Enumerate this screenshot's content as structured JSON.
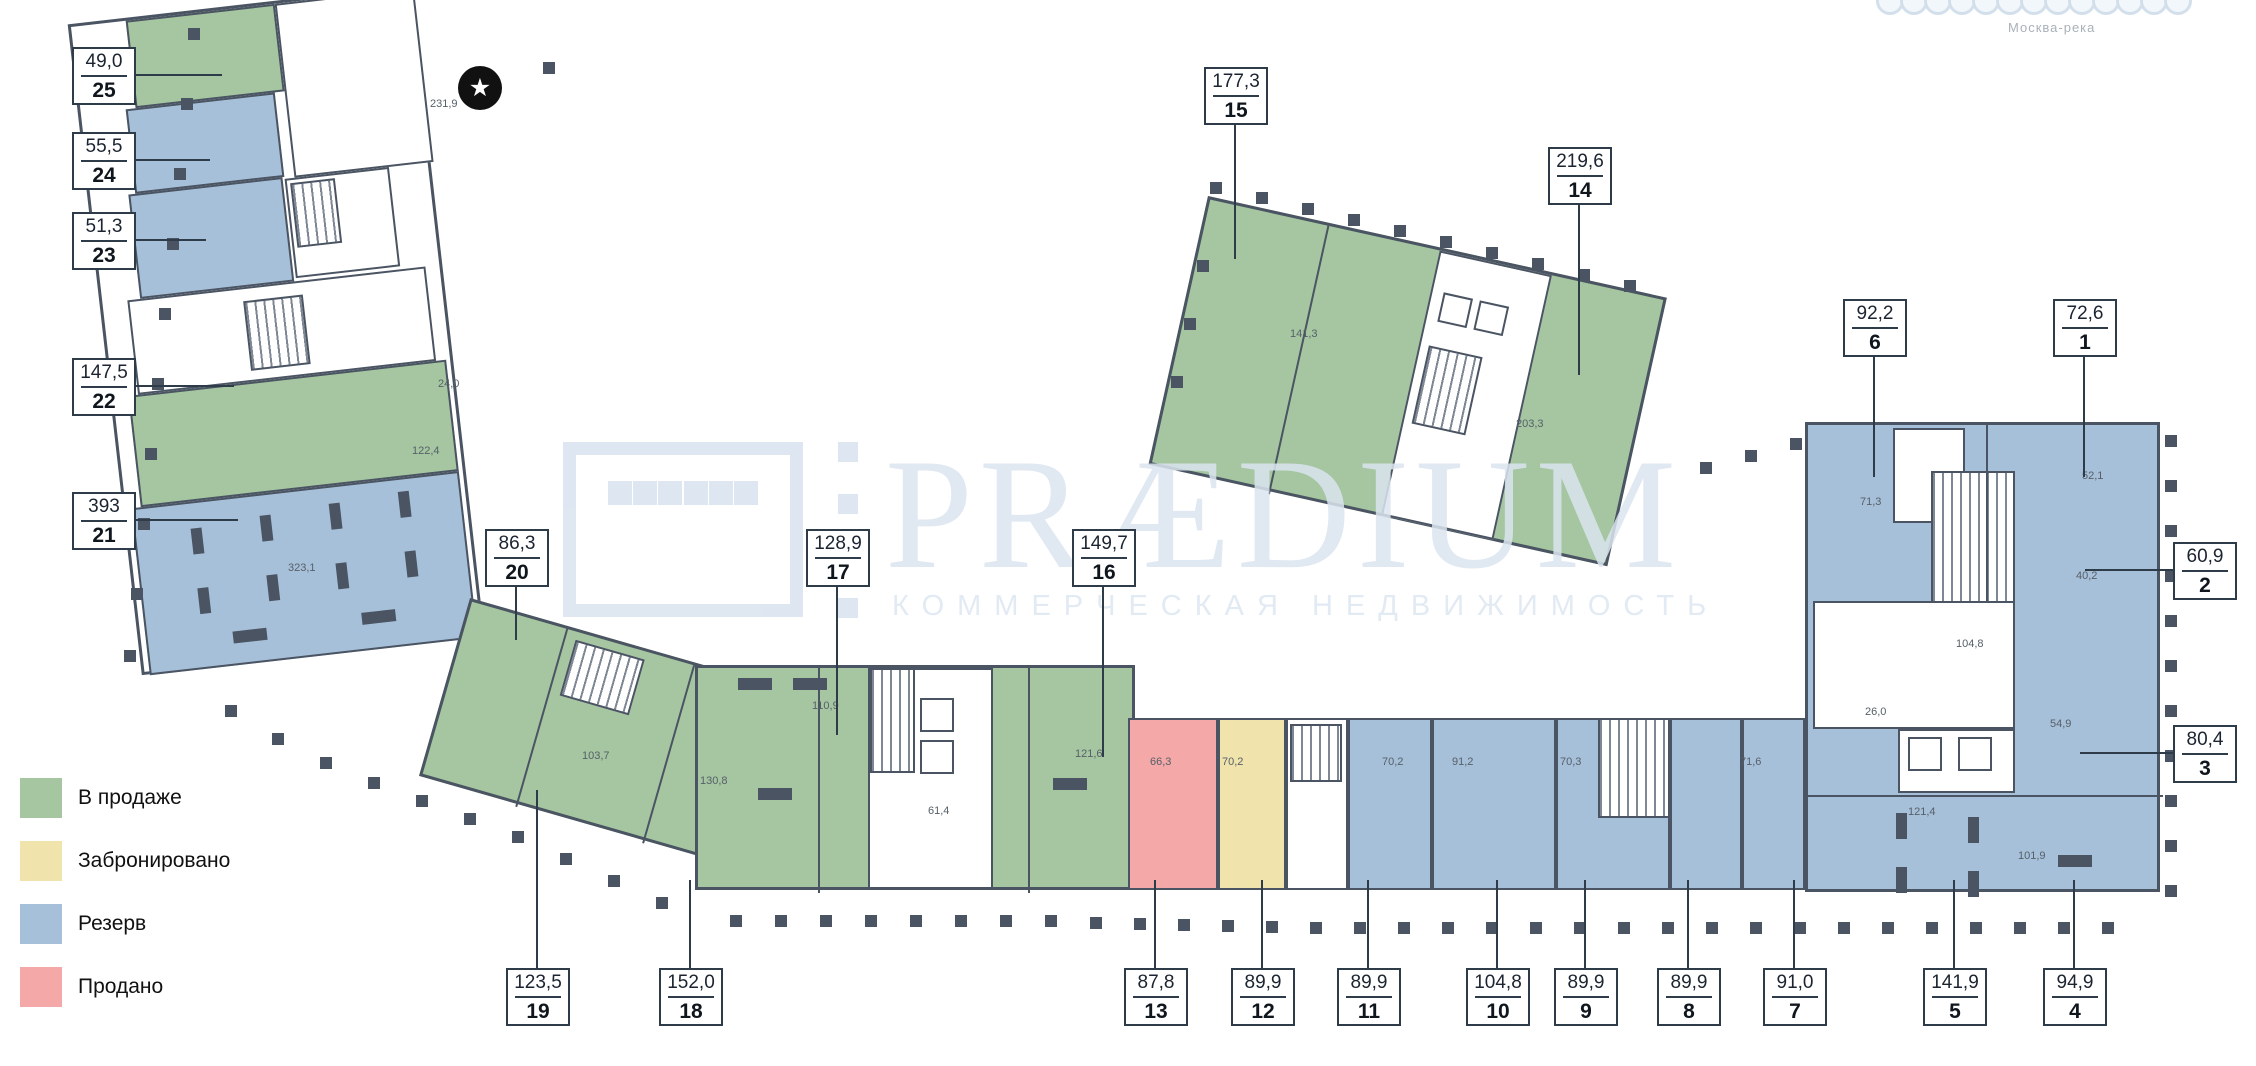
{
  "watermark": {
    "brand": "PRÆDIUM",
    "tagline": "КОММЕРЧЕСКАЯ НЕДВИЖИМОСТЬ",
    "color": "#dbe5f0"
  },
  "map_note": "Москва-река",
  "star_marker": "★",
  "status_colors": {
    "available": "#a5c6a1",
    "booked": "#f0e3ab",
    "reserved": "#a7c0d9",
    "sold": "#f4a8a8"
  },
  "legend": {
    "items": [
      {
        "label": "В продаже",
        "status": "available"
      },
      {
        "label": "Забронировано",
        "status": "booked"
      },
      {
        "label": "Резерв",
        "status": "reserved"
      },
      {
        "label": "Продано",
        "status": "sold"
      }
    ]
  },
  "units": [
    {
      "number": "25",
      "area": "49,0",
      "status": "available",
      "box": {
        "x": 72,
        "y": 47
      },
      "leader": {
        "dir": "right",
        "len": 88
      }
    },
    {
      "number": "24",
      "area": "55,5",
      "status": "reserved",
      "box": {
        "x": 72,
        "y": 132
      },
      "leader": {
        "dir": "right",
        "len": 76
      }
    },
    {
      "number": "23",
      "area": "51,3",
      "status": "reserved",
      "box": {
        "x": 72,
        "y": 212
      },
      "leader": {
        "dir": "right",
        "len": 72
      }
    },
    {
      "number": "22",
      "area": "147,5",
      "status": "available",
      "box": {
        "x": 72,
        "y": 358
      },
      "leader": {
        "dir": "right",
        "len": 100
      }
    },
    {
      "number": "21",
      "area": "393",
      "status": "reserved",
      "box": {
        "x": 72,
        "y": 492
      },
      "leader": {
        "dir": "right",
        "len": 104
      }
    },
    {
      "number": "20",
      "area": "86,3",
      "status": "available",
      "box": {
        "x": 485,
        "y": 529
      },
      "leader": {
        "dir": "down",
        "len": 55
      }
    },
    {
      "number": "17",
      "area": "128,9",
      "status": "available",
      "box": {
        "x": 806,
        "y": 529
      },
      "leader": {
        "dir": "down",
        "len": 150
      }
    },
    {
      "number": "16",
      "area": "149,7",
      "status": "available",
      "box": {
        "x": 1072,
        "y": 529
      },
      "leader": {
        "dir": "down",
        "len": 172
      }
    },
    {
      "number": "15",
      "area": "177,3",
      "status": "available",
      "box": {
        "x": 1204,
        "y": 67
      },
      "leader": {
        "dir": "down",
        "len": 136
      }
    },
    {
      "number": "14",
      "area": "219,6",
      "status": "available",
      "box": {
        "x": 1548,
        "y": 147
      },
      "leader": {
        "dir": "down",
        "len": 172
      }
    },
    {
      "number": "6",
      "area": "92,2",
      "status": "reserved",
      "box": {
        "x": 1843,
        "y": 299
      },
      "leader": {
        "dir": "down",
        "len": 122
      }
    },
    {
      "number": "1",
      "area": "72,6",
      "status": "reserved",
      "box": {
        "x": 2053,
        "y": 299
      },
      "leader": {
        "dir": "down",
        "len": 122
      }
    },
    {
      "number": "2",
      "area": "60,9",
      "status": "reserved",
      "box": {
        "x": 2173,
        "y": 542
      },
      "leader": {
        "dir": "left",
        "len": 88
      }
    },
    {
      "number": "3",
      "area": "80,4",
      "status": "reserved",
      "box": {
        "x": 2173,
        "y": 725
      },
      "leader": {
        "dir": "left",
        "len": 93
      }
    },
    {
      "number": "19",
      "area": "123,5",
      "status": "available",
      "box": {
        "x": 506,
        "y": 968
      },
      "leader": {
        "dir": "up",
        "len": 178
      }
    },
    {
      "number": "18",
      "area": "152,0",
      "status": "available",
      "box": {
        "x": 659,
        "y": 968
      },
      "leader": {
        "dir": "up",
        "len": 88
      }
    },
    {
      "number": "13",
      "area": "87,8",
      "status": "sold",
      "box": {
        "x": 1124,
        "y": 968
      },
      "leader": {
        "dir": "up",
        "len": 88
      }
    },
    {
      "number": "12",
      "area": "89,9",
      "status": "booked",
      "box": {
        "x": 1231,
        "y": 968
      },
      "leader": {
        "dir": "up",
        "len": 88
      }
    },
    {
      "number": "11",
      "area": "89,9",
      "status": "reserved",
      "box": {
        "x": 1337,
        "y": 968
      },
      "leader": {
        "dir": "up",
        "len": 88
      }
    },
    {
      "number": "10",
      "area": "104,8",
      "status": "reserved",
      "box": {
        "x": 1466,
        "y": 968
      },
      "leader": {
        "dir": "up",
        "len": 88
      }
    },
    {
      "number": "9",
      "area": "89,9",
      "status": "reserved",
      "box": {
        "x": 1554,
        "y": 968
      },
      "leader": {
        "dir": "up",
        "len": 88
      }
    },
    {
      "number": "8",
      "area": "89,9",
      "status": "reserved",
      "box": {
        "x": 1657,
        "y": 968
      },
      "leader": {
        "dir": "up",
        "len": 88
      }
    },
    {
      "number": "7",
      "area": "91,0",
      "status": "reserved",
      "box": {
        "x": 1763,
        "y": 968
      },
      "leader": {
        "dir": "up",
        "len": 88
      }
    },
    {
      "number": "5",
      "area": "141,9",
      "status": "reserved",
      "box": {
        "x": 1923,
        "y": 968
      },
      "leader": {
        "dir": "up",
        "len": 88
      }
    },
    {
      "number": "4",
      "area": "94,9",
      "status": "reserved",
      "box": {
        "x": 2043,
        "y": 968
      },
      "leader": {
        "dir": "up",
        "len": 88
      }
    }
  ],
  "rooms": [
    {
      "t": "231,9",
      "x": 430,
      "y": 98
    },
    {
      "t": "24,0",
      "x": 438,
      "y": 378
    },
    {
      "t": "122,4",
      "x": 412,
      "y": 445
    },
    {
      "t": "323,1",
      "x": 288,
      "y": 562
    },
    {
      "t": "141,3",
      "x": 1290,
      "y": 328
    },
    {
      "t": "203,3",
      "x": 1516,
      "y": 418
    },
    {
      "t": "103,7",
      "x": 582,
      "y": 750
    },
    {
      "t": "130,8",
      "x": 700,
      "y": 775
    },
    {
      "t": "110,9",
      "x": 812,
      "y": 700
    },
    {
      "t": "61,4",
      "x": 928,
      "y": 805
    },
    {
      "t": "121,6",
      "x": 1075,
      "y": 748
    },
    {
      "t": "66,3",
      "x": 1150,
      "y": 756
    },
    {
      "t": "70,2",
      "x": 1222,
      "y": 756
    },
    {
      "t": "70,2",
      "x": 1382,
      "y": 756
    },
    {
      "t": "91,2",
      "x": 1452,
      "y": 756
    },
    {
      "t": "70,3",
      "x": 1560,
      "y": 756
    },
    {
      "t": "71,6",
      "x": 1740,
      "y": 756
    },
    {
      "t": "71,3",
      "x": 1860,
      "y": 496
    },
    {
      "t": "52,1",
      "x": 2082,
      "y": 470
    },
    {
      "t": "40,2",
      "x": 2076,
      "y": 570
    },
    {
      "t": "104,8",
      "x": 1956,
      "y": 638
    },
    {
      "t": "26,0",
      "x": 1865,
      "y": 706
    },
    {
      "t": "54,9",
      "x": 2050,
      "y": 718
    },
    {
      "t": "121,4",
      "x": 1908,
      "y": 806
    },
    {
      "t": "101,9",
      "x": 2018,
      "y": 850
    }
  ],
  "site_dots": [
    [
      188,
      28
    ],
    [
      181,
      98
    ],
    [
      174,
      168
    ],
    [
      167,
      238
    ],
    [
      159,
      308
    ],
    [
      152,
      378
    ],
    [
      145,
      448
    ],
    [
      138,
      518
    ],
    [
      131,
      588
    ],
    [
      124,
      650
    ],
    [
      543,
      62
    ],
    [
      225,
      705
    ],
    [
      272,
      733
    ],
    [
      320,
      757
    ],
    [
      368,
      777
    ],
    [
      416,
      795
    ],
    [
      464,
      813
    ],
    [
      512,
      831
    ],
    [
      560,
      853
    ],
    [
      608,
      875
    ],
    [
      656,
      897
    ],
    [
      730,
      915
    ],
    [
      775,
      915
    ],
    [
      820,
      915
    ],
    [
      865,
      915
    ],
    [
      910,
      915
    ],
    [
      955,
      915
    ],
    [
      1000,
      915
    ],
    [
      1045,
      915
    ],
    [
      1090,
      917
    ],
    [
      1134,
      918
    ],
    [
      1178,
      919
    ],
    [
      1222,
      920
    ],
    [
      1266,
      921
    ],
    [
      1310,
      922
    ],
    [
      1354,
      922
    ],
    [
      1398,
      922
    ],
    [
      1442,
      922
    ],
    [
      1486,
      922
    ],
    [
      1530,
      922
    ],
    [
      1574,
      922
    ],
    [
      1618,
      922
    ],
    [
      1662,
      922
    ],
    [
      1706,
      922
    ],
    [
      1750,
      922
    ],
    [
      1794,
      922
    ],
    [
      1838,
      922
    ],
    [
      1882,
      922
    ],
    [
      1926,
      922
    ],
    [
      1970,
      922
    ],
    [
      2014,
      922
    ],
    [
      2058,
      922
    ],
    [
      2102,
      922
    ],
    [
      2165,
      435
    ],
    [
      2165,
      480
    ],
    [
      2165,
      525
    ],
    [
      2165,
      570
    ],
    [
      2165,
      615
    ],
    [
      2165,
      660
    ],
    [
      2165,
      705
    ],
    [
      2165,
      750
    ],
    [
      2165,
      795
    ],
    [
      2165,
      840
    ],
    [
      2165,
      885
    ],
    [
      1210,
      182
    ],
    [
      1256,
      192
    ],
    [
      1302,
      203
    ],
    [
      1348,
      214
    ],
    [
      1394,
      225
    ],
    [
      1440,
      236
    ],
    [
      1486,
      247
    ],
    [
      1532,
      258
    ],
    [
      1578,
      269
    ],
    [
      1624,
      280
    ],
    [
      1197,
      260
    ],
    [
      1184,
      318
    ],
    [
      1171,
      376
    ],
    [
      1700,
      462
    ],
    [
      1745,
      450
    ],
    [
      1790,
      438
    ]
  ]
}
